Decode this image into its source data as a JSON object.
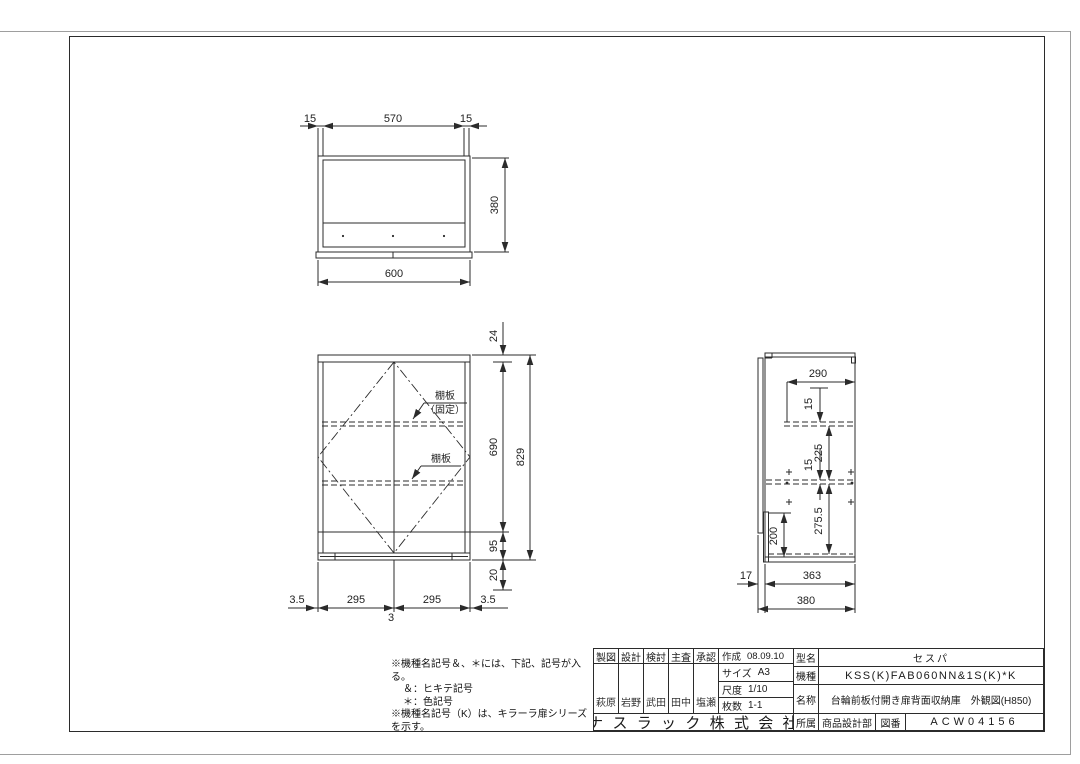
{
  "views": {
    "top": {
      "d15l": "15",
      "d570": "570",
      "d15r": "15",
      "d380": "380",
      "d600": "600"
    },
    "front": {
      "d24": "24",
      "d690": "690",
      "d829": "829",
      "d95": "95",
      "d20": "20",
      "d35l": "3.5",
      "d295l": "295",
      "d3": "3",
      "d295r": "295",
      "d35r": "3.5",
      "shelf_fixed_line1": "棚板",
      "shelf_fixed_line2": "（固定）",
      "shelf": "棚板"
    },
    "side": {
      "d290": "290",
      "d15a": "15",
      "d225": "225",
      "d15b": "15",
      "d2755": "275.5",
      "d200": "200",
      "d17": "17",
      "d363": "363",
      "d380": "380"
    }
  },
  "notes": {
    "lines": [
      "※機種名記号＆、＊には、下記、記号が入る。",
      "＆：ヒキテ記号",
      "＊：色記号",
      "※機種名記号（K）は、キラーラ扉シリーズを示す。"
    ]
  },
  "title_block": {
    "cols": [
      {
        "role": "製図",
        "name": "萩原"
      },
      {
        "role": "設計",
        "name": "岩野"
      },
      {
        "role": "検討",
        "name": "武田"
      },
      {
        "role": "主査",
        "name": "田中"
      },
      {
        "role": "承認",
        "name": "塩瀬"
      }
    ],
    "created_label": "作成",
    "created": "08.09.10",
    "size_label": "サイズ",
    "size": "A3",
    "scale_label": "尺度",
    "scale": "1/10",
    "sheets_label": "枚数",
    "sheets": "1-1",
    "company": "ナスラック株式会社",
    "model_label": "型名",
    "model": "セスパ",
    "machine_label": "機種",
    "machine": "KSS(K)FAB060NN&1S(K)*K",
    "name_label": "名称",
    "product_name": "台輪前板付開き扉背面収納庫　外観図(H850)",
    "dept_label": "所属",
    "dept": "商品設計部",
    "dwg_label": "図番",
    "dwg_no": "ACW04156"
  }
}
